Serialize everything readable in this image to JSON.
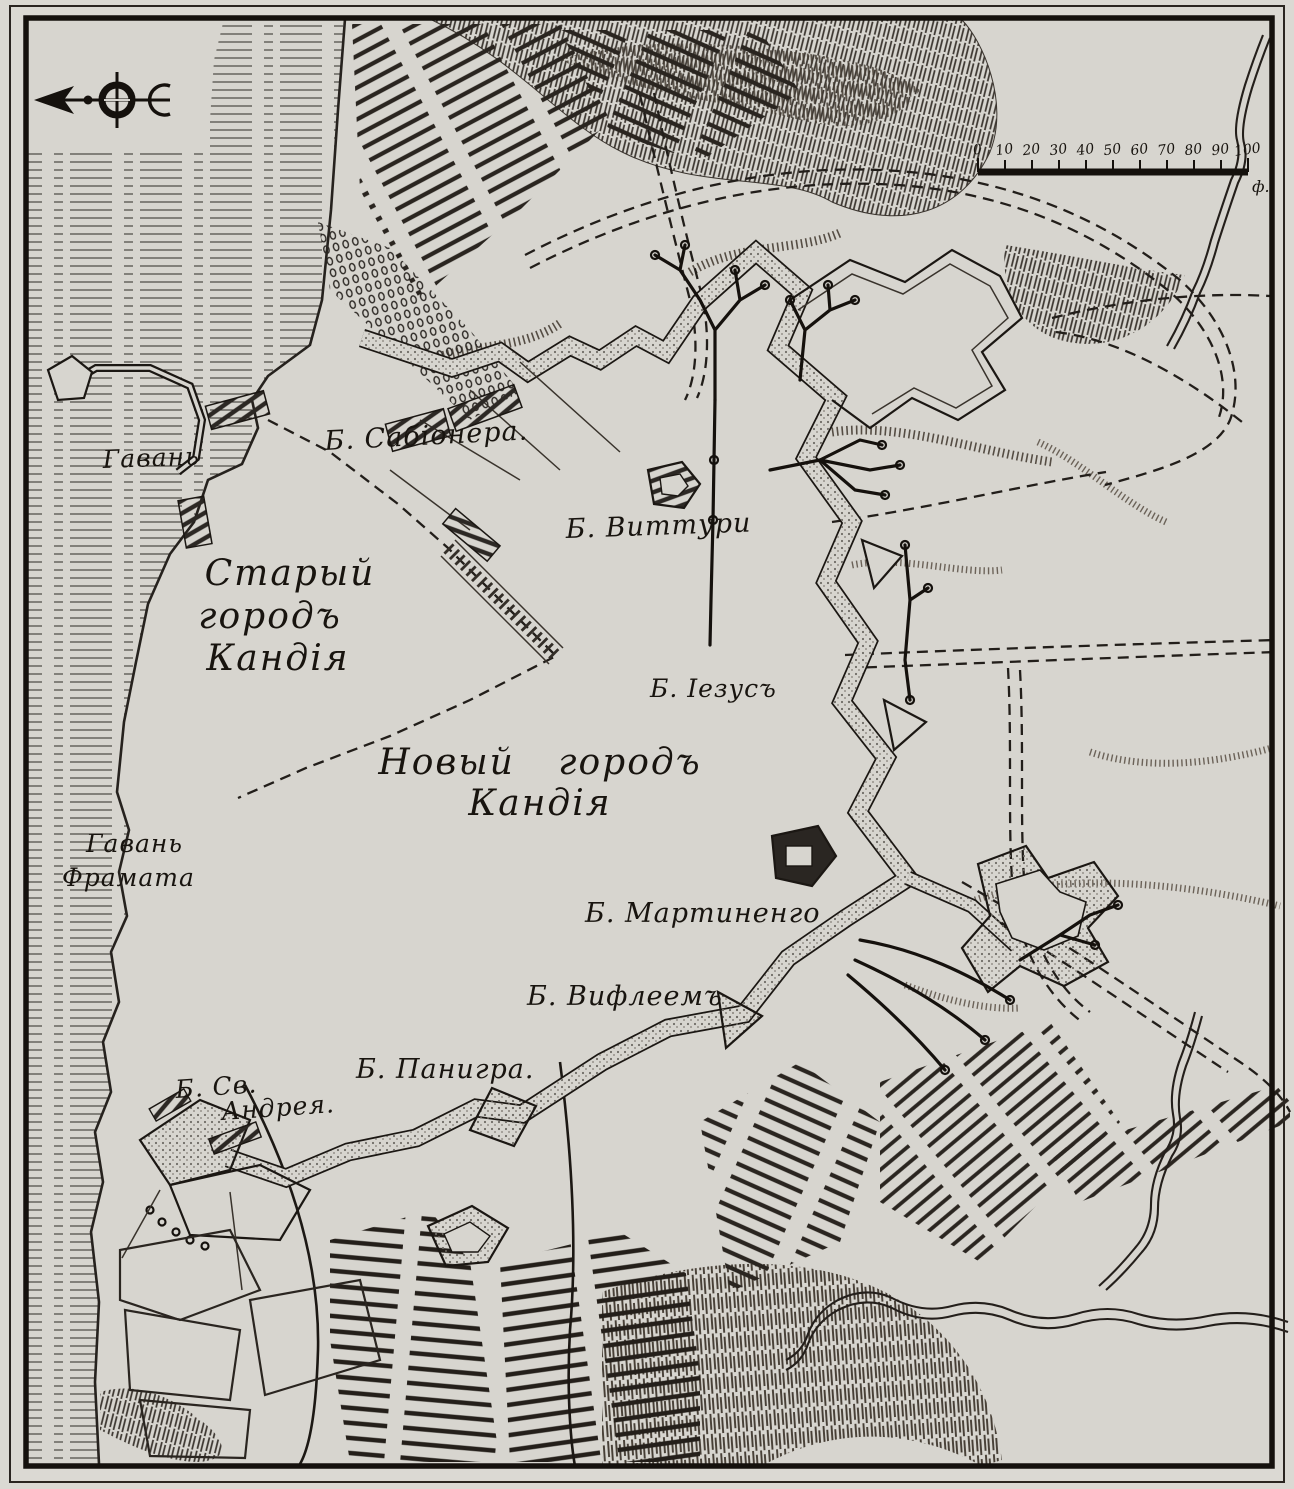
{
  "map": {
    "kind": "engraved-siege-map-of-candia",
    "colors": {
      "paper": "#dbd9d3",
      "ink": "#18140f",
      "stipple": "#6e6a64"
    },
    "labels": {
      "harbor": "Гавань",
      "old_town_line1": "Старый",
      "old_town_line2": "городъ",
      "old_town_line3": "Кандія",
      "new_town_line1": "Новый  городъ",
      "new_town_line2": "Кандія",
      "harbor_framata_line1": "Гавань",
      "harbor_framata_line2": "Фрамата",
      "bastion_sabionera": "Б. Сабіонера.",
      "bastion_vitturi": "Б. Виттури",
      "bastion_jesus": "Б. Іезусъ",
      "bastion_martinengo": "Б. Мартиненго",
      "bastion_bethlehem": "Б. Вифлеемъ",
      "bastion_panigra": "Б. Панигра.",
      "bastion_st_andrew_line1": "Б. Св.",
      "bastion_st_andrew_line2": "Андрея."
    },
    "scale_bar": {
      "ticks": [
        "0",
        "10",
        "20",
        "30",
        "40",
        "50",
        "60",
        "70",
        "80",
        "90",
        "100"
      ],
      "unit": "ф."
    },
    "icons": {
      "compass": "north-arrow-with-crescent"
    }
  }
}
